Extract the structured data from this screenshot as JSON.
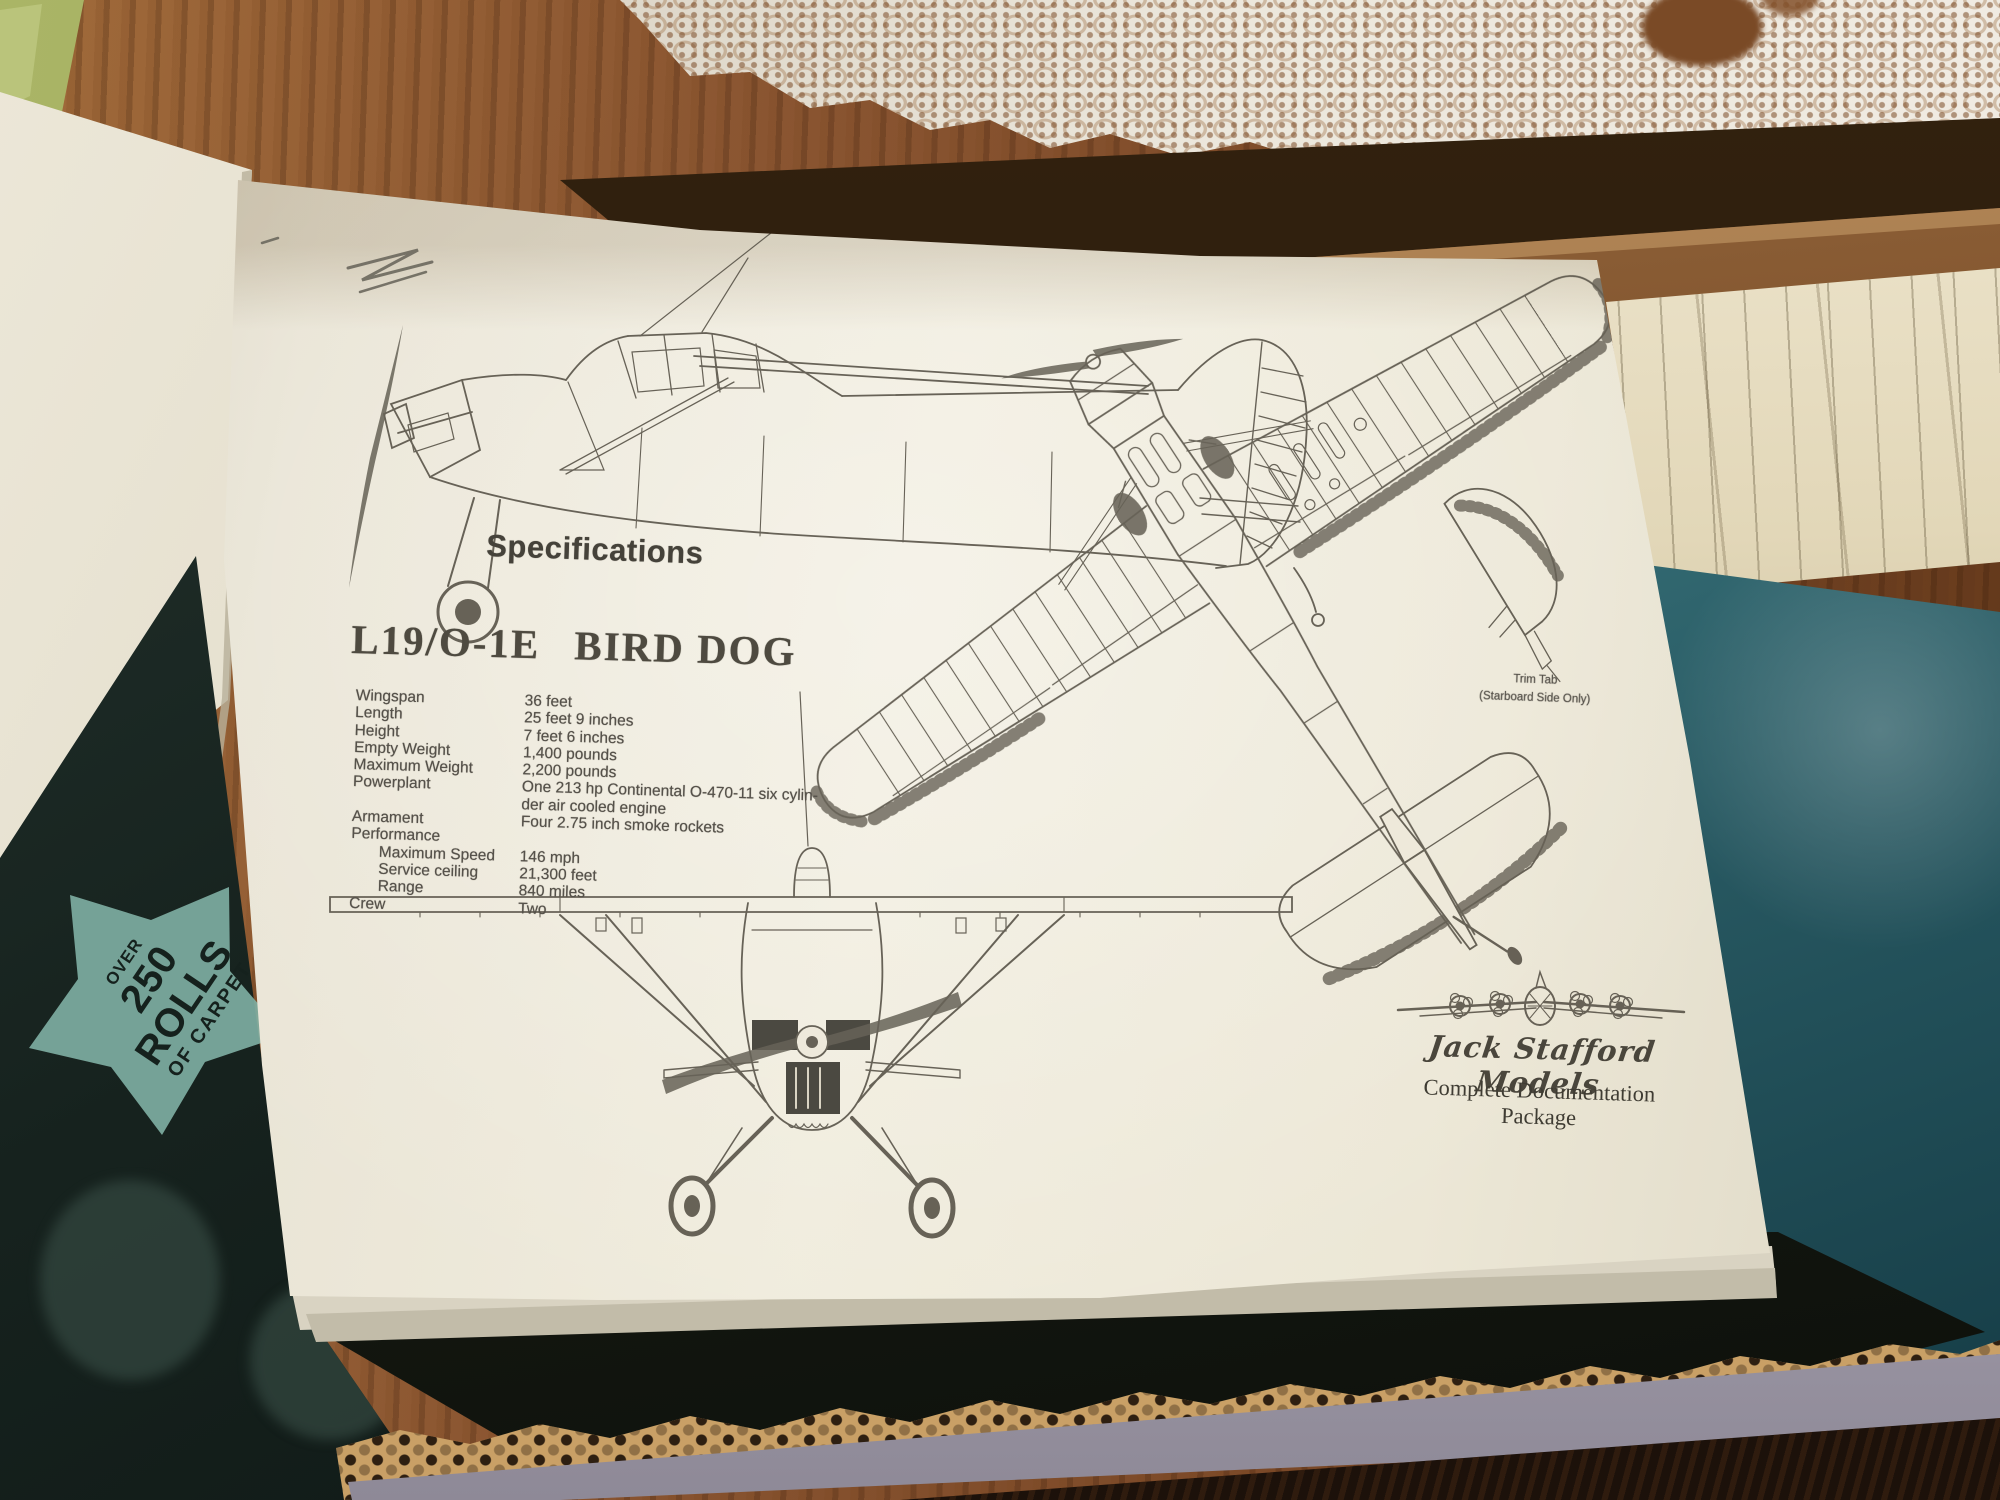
{
  "page": {
    "specifications_heading": "Specifications",
    "title_model": "L19/O-1E",
    "title_name": "BIRD DOG",
    "specs": {
      "rows": [
        {
          "label": "Wingspan",
          "value": "36 feet"
        },
        {
          "label": "Length",
          "value": "25 feet 9 inches"
        },
        {
          "label": "Height",
          "value": "7 feet 6 inches"
        },
        {
          "label": "Empty Weight",
          "value": "1,400 pounds"
        },
        {
          "label": "Maximum Weight",
          "value": "2,200 pounds"
        },
        {
          "label": "Powerplant",
          "value": "One 213 hp Continental O-470-11 six cylin-"
        },
        {
          "label": "",
          "value": "der air cooled engine"
        },
        {
          "label": "Armament",
          "value": "Four 2.75 inch smoke rockets"
        },
        {
          "label": "Performance",
          "value": ""
        },
        {
          "label": "Maximum Speed",
          "value": "146 mph",
          "indent": true
        },
        {
          "label": "Service ceiling",
          "value": "21,300 feet",
          "indent": true
        },
        {
          "label": "Range",
          "value": "840 miles",
          "indent": true
        },
        {
          "label": "Crew",
          "value": "Two"
        }
      ]
    },
    "trim_tab_note": {
      "line1": "Trim Tab",
      "line2": "(Starboard Side Only)"
    },
    "footer": {
      "brand": "Jack Stafford Models",
      "caption": "Complete Documentation Package"
    }
  },
  "newspaper": {
    "starburst_over": "OVER",
    "starburst_main": "250 ROLLS",
    "starburst_sub": "OF CARPET",
    "shadow_text": "FOR"
  },
  "colors": {
    "paper": "#ece7d6",
    "ink": "#55514a",
    "wood_table": "#8a5531",
    "teal_cover": "#3f7d85",
    "cardboard": "#c9a066",
    "box_face": "#b0abb9",
    "newspaper_star": "#7fb0a4",
    "doily": "#ece7dc"
  }
}
